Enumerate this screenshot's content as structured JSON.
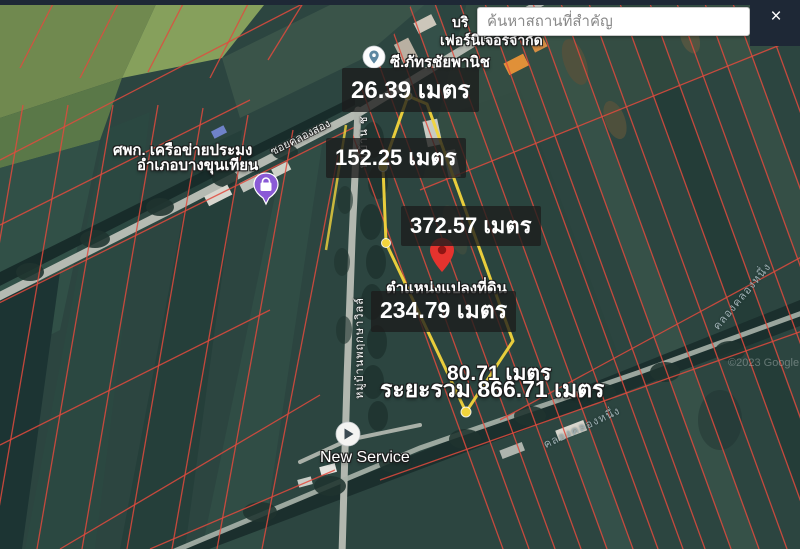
{
  "topbar": {
    "search_placeholder": "ค้นหาสถานที่สำคัญ",
    "close_label": "×"
  },
  "plot": {
    "pin_label": "ตำแหน่งแปลงที่ดิน",
    "measurements": {
      "top_edge": "26.39 เมตร",
      "upper_left_edge": "152.25 เมตร",
      "right_edge": "372.57 เมตร",
      "lower_left_edge": "234.79 เมตร",
      "bottom_edge": "80.71 เมตร",
      "total": "ระยะรวม 866.71 เมตร"
    }
  },
  "pois": {
    "furniture_company": {
      "line1": "บริ",
      "line2": "เฟอร์นิเจอร์จำกัด"
    },
    "shop": {
      "label": "ซี.ภัทรชัยพานิช"
    },
    "fishery_center": {
      "line1": "ศพก. เครือข่ายประมง",
      "line2": "อำเภอบางขุนเทียน"
    },
    "new_service": {
      "label": "New Service"
    }
  },
  "roads": {
    "village_road_upper": "หมู่บ้าน ช",
    "village_road_lower": "หมู่บ้านพฤกษาวิลล์",
    "soi_label": "ซอยคลองสอง",
    "canal_right": "คลองคลองหนึ่ง",
    "canal_bottom": "คลองคลองหนึ่ง"
  },
  "watermark": "©2023 Google",
  "colors": {
    "plot_outline": "#f2d53c",
    "parcel_line": "#e14b3e",
    "pin_color": "#e5332e",
    "poi_purple": "#8a5ad6",
    "panel_dark": "#1e2836"
  }
}
